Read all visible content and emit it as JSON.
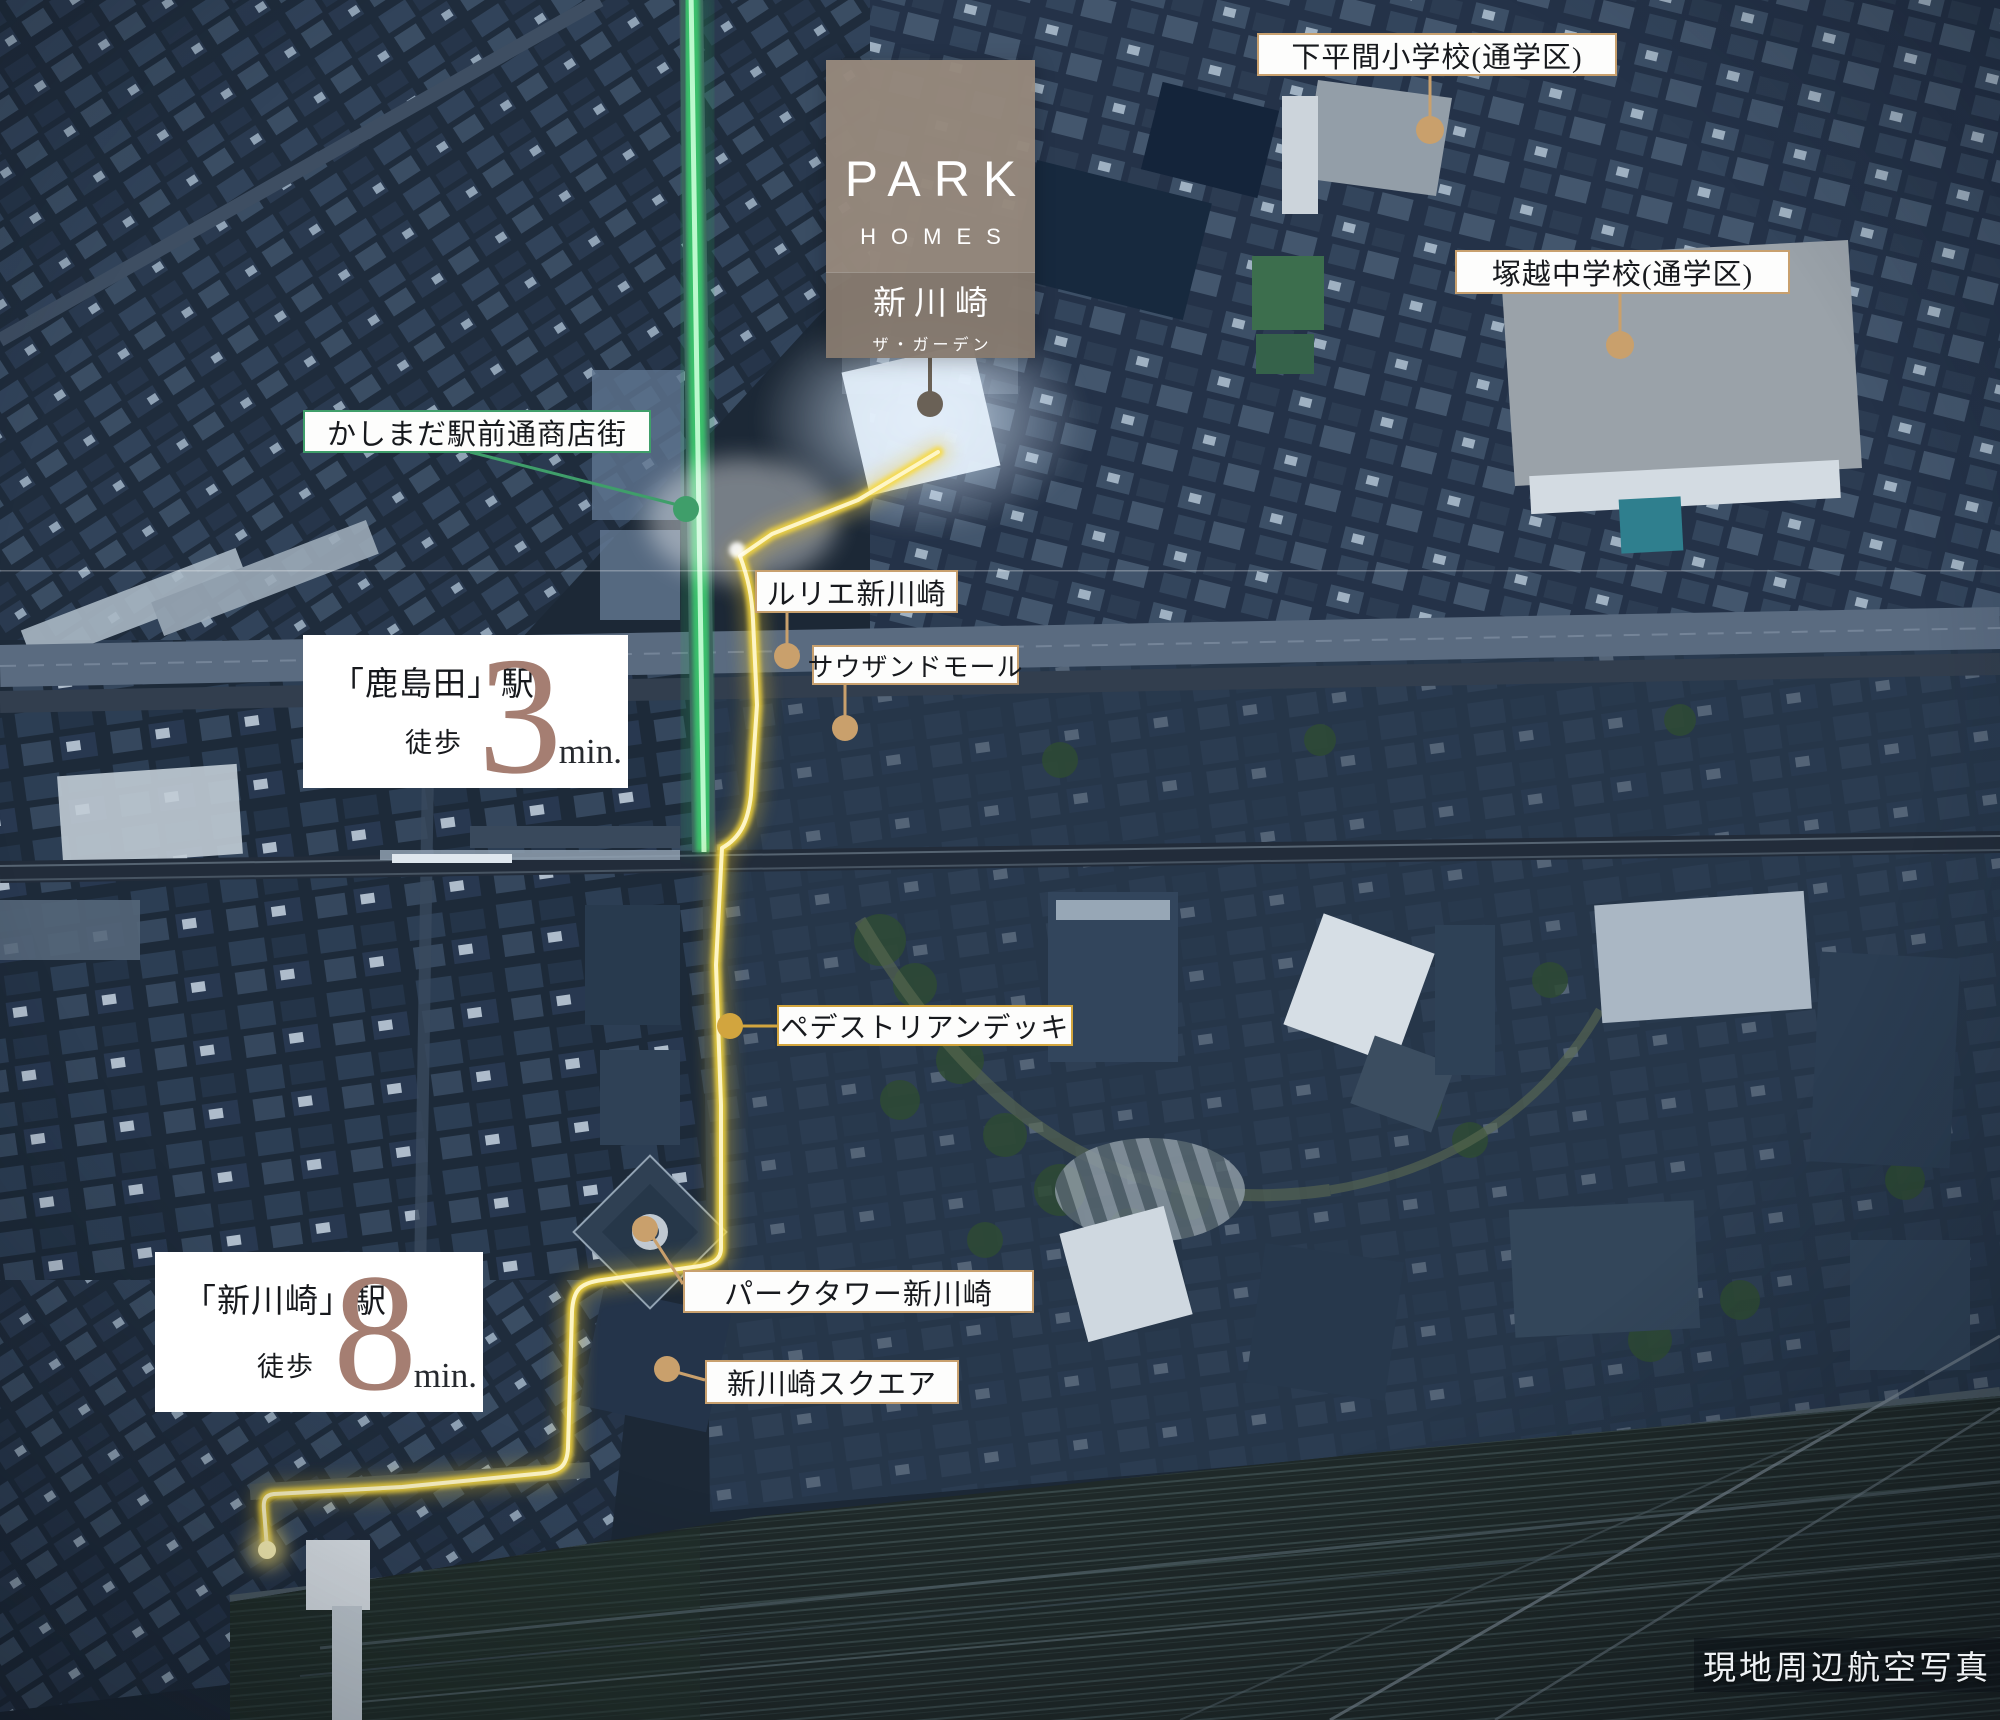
{
  "logo": {
    "brand": "PARK",
    "brand_sub": "HOMES",
    "property": "新川崎",
    "property_sub": "ザ・ガーデン"
  },
  "map_labels": {
    "elementary_school": "下平間小学校(通学区)",
    "junior_high_school": "塚越中学校(通学区)",
    "shopping_street": "かしまだ駅前通商店街",
    "lurie_shinkawasaki": "ルリエ新川崎",
    "thousand_mall": "サウザンドモール",
    "pedestrian_deck": "ペデストリアンデッキ",
    "park_tower_shinkawasaki": "パークタワー新川崎",
    "shinkawasaki_square": "新川崎スクエア"
  },
  "stations": {
    "kashimada": {
      "name": "「鹿島田」駅",
      "walk": "徒歩",
      "minutes": "3",
      "unit": "min."
    },
    "shinkawasaki": {
      "name": "「新川崎」駅",
      "walk": "徒歩",
      "minutes": "8",
      "unit": "min."
    }
  },
  "caption": "現地周辺航空写真",
  "colors": {
    "label_border_tan": "#c8a06e",
    "label_border_green": "#3f9e6a",
    "label_border_gold": "#d2a53e",
    "pin_dot_tan": "#c9a06c",
    "route_yellow": "#f5d435",
    "street_green": "#3ad06e",
    "minutes_accent": "#a57e72",
    "logo_background": "#96887c"
  }
}
